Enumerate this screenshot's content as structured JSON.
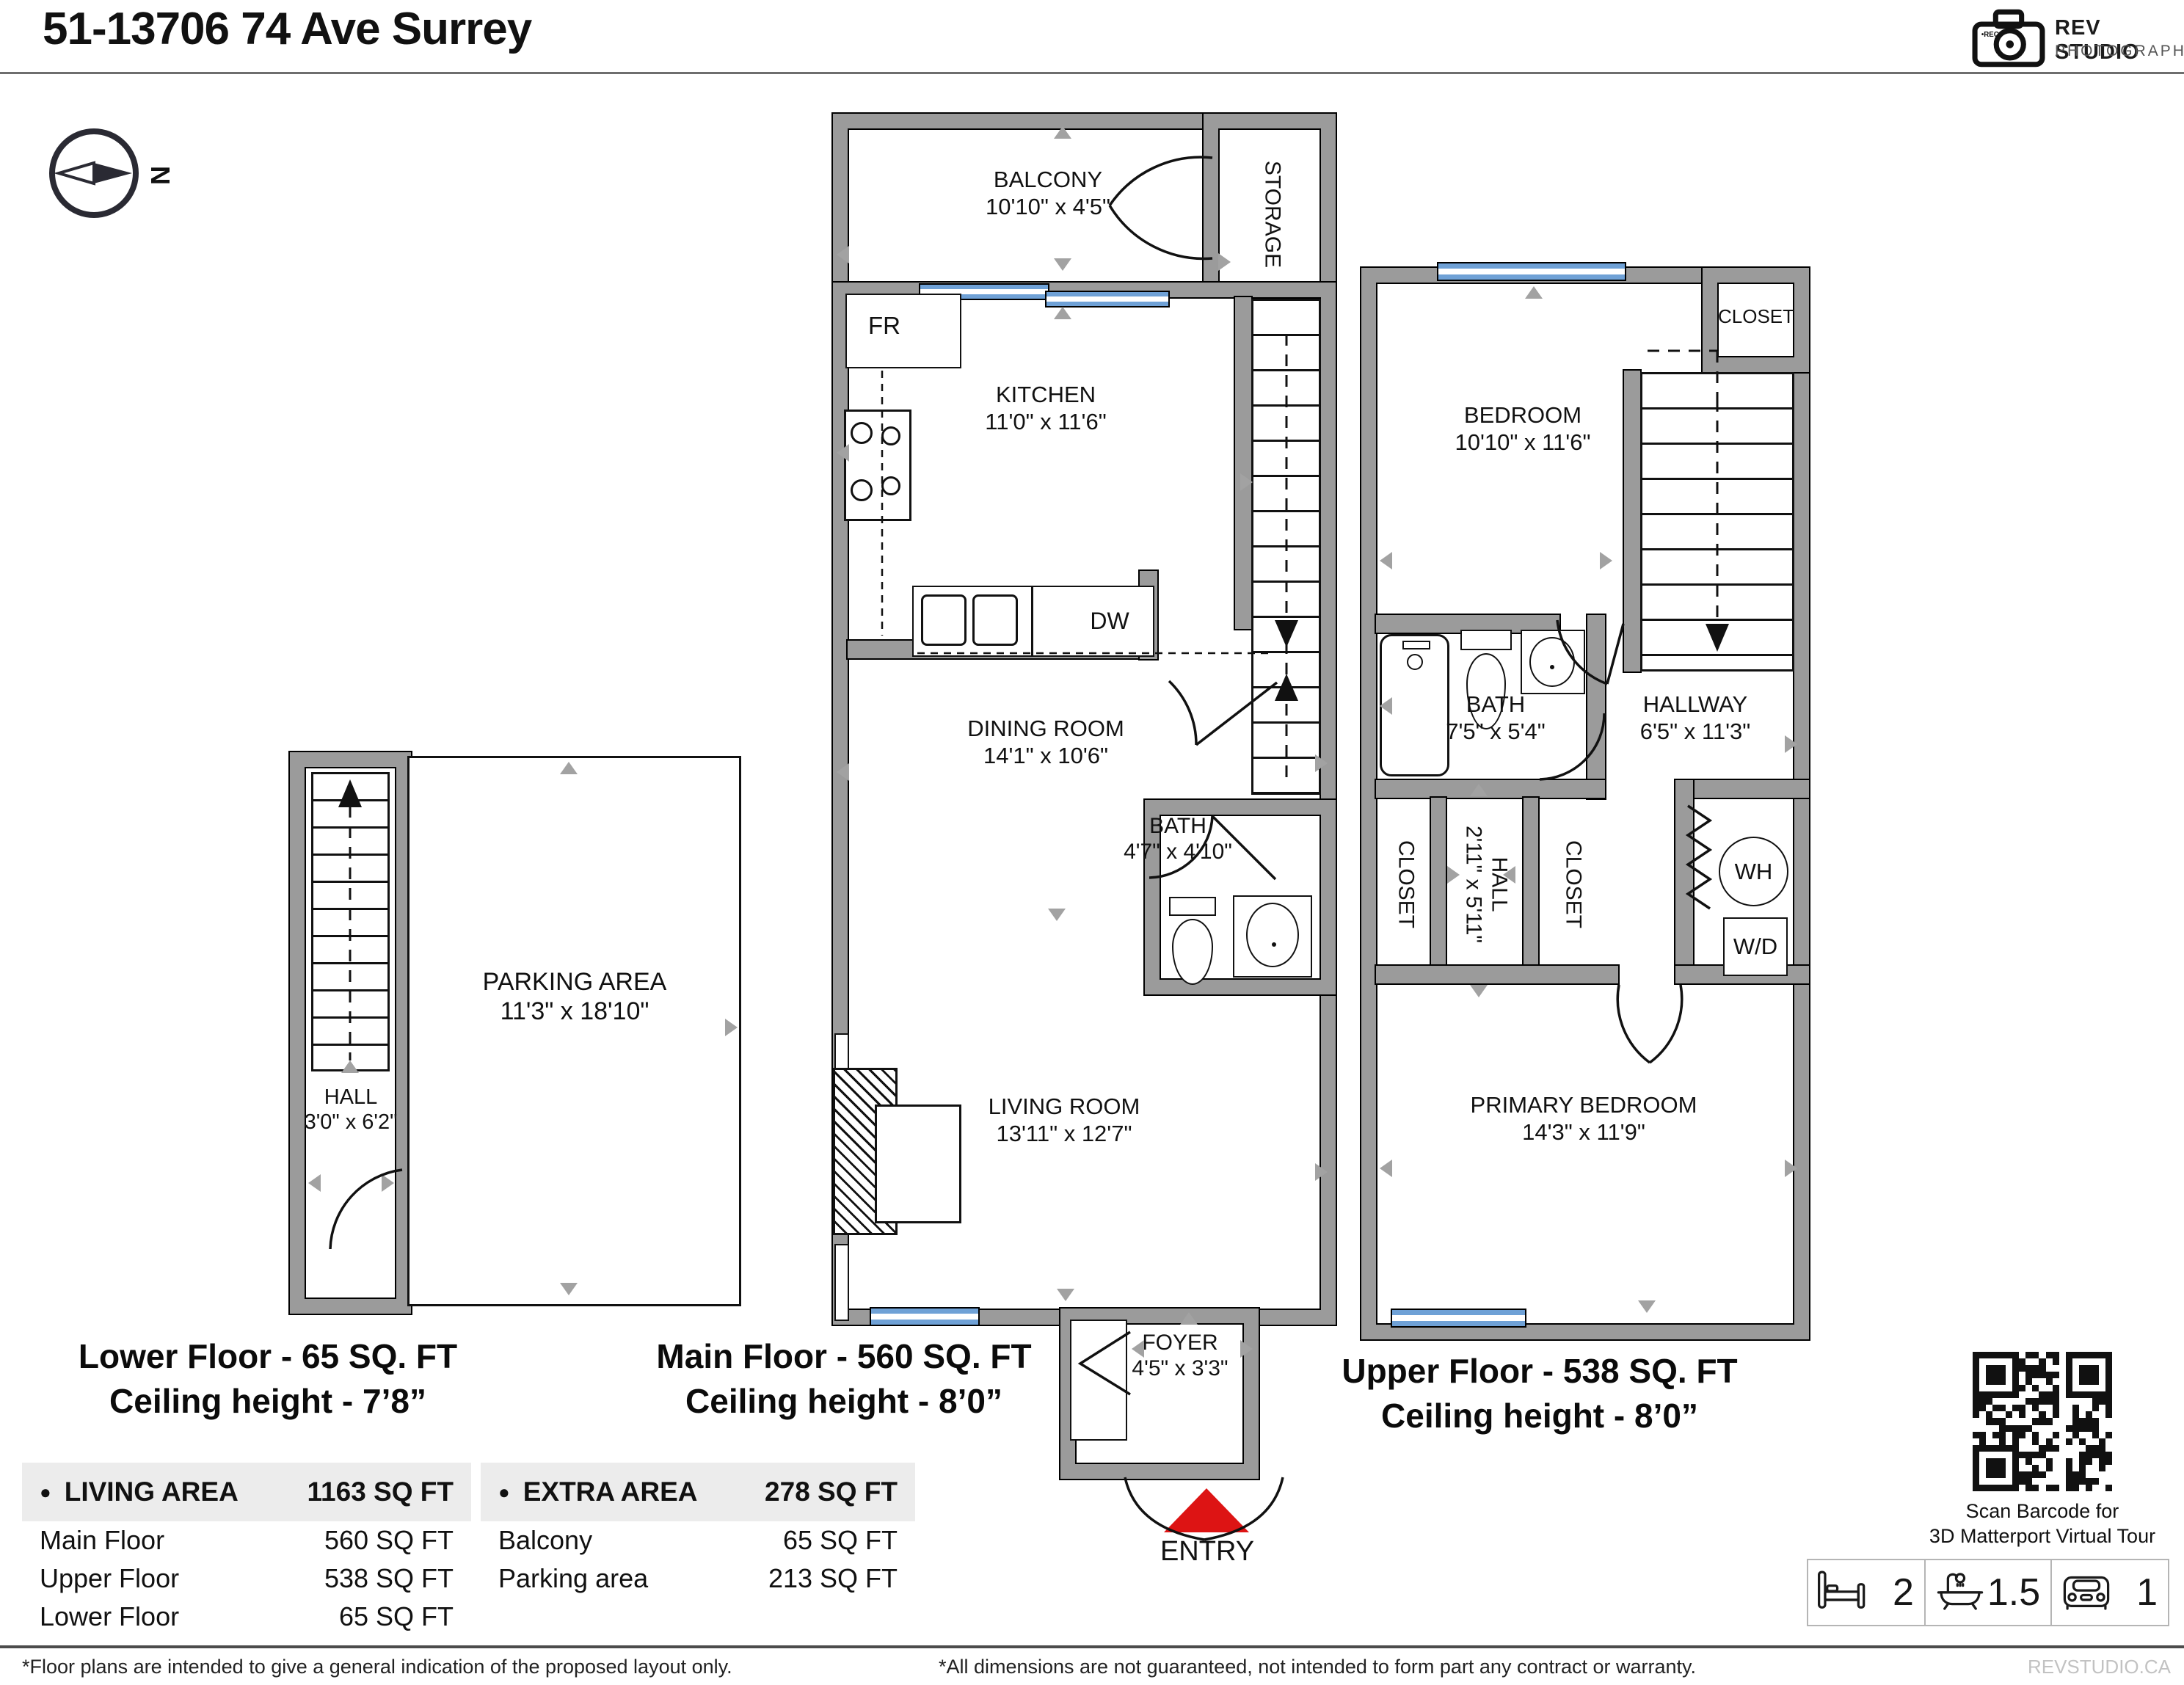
{
  "header": {
    "title": "51-13706 74 Ave Surrey",
    "logo_line1": "REV STUDIO",
    "logo_line2": "PHOTOGRAPHY",
    "logo_rec": "REC",
    "compass_n": "N"
  },
  "plans": {
    "main": {
      "caption1": "Main Floor - 560 SQ. FT",
      "caption2": "Ceiling height - 8’0”",
      "balcony_name": "BALCONY",
      "balcony_dims": "10'10\" x 4'5\"",
      "storage": "STORAGE",
      "fr": "FR",
      "dw": "DW",
      "kitchen_name": "KITCHEN",
      "kitchen_dims": "11'0\" x 11'6\"",
      "dining_name": "DINING ROOM",
      "dining_dims": "14'1\" x 10'6\"",
      "bath_name": "BATH",
      "bath_dims": "4'7\" x 4'10\"",
      "living_name": "LIVING ROOM",
      "living_dims": "13'11\" x 12'7\"",
      "foyer_name": "FOYER",
      "foyer_dims": "4'5\" x 3'3\"",
      "entry": "ENTRY"
    },
    "upper": {
      "caption1": "Upper Floor - 538 SQ. FT",
      "caption2": "Ceiling height - 8’0”",
      "closet_top": "CLOSET",
      "bedroom_name": "BEDROOM",
      "bedroom_dims": "10'10\" x 11'6\"",
      "bath_name": "BATH",
      "bath_dims": "7'5\" x 5'4\"",
      "hallway_name": "HALLWAY",
      "hallway_dims": "6'5\" x 11'3\"",
      "closet_left": "CLOSET",
      "closet_right": "CLOSET",
      "hall_name": "HALL",
      "hall_dims": "2'11\" x 5'11\"",
      "wh": "WH",
      "wd": "W/D",
      "primary_name": "PRIMARY BEDROOM",
      "primary_dims": "14'3\" x 11'9\""
    },
    "lower": {
      "caption1": "Lower Floor - 65 SQ. FT",
      "caption2": "Ceiling height - 7’8”",
      "parking_name": "PARKING AREA",
      "parking_dims": "11'3\" x 18'10\"",
      "hall_name": "HALL",
      "hall_dims": "3'0\" x 6'2\""
    }
  },
  "tables": {
    "living_area": {
      "bullet": "●",
      "title": "LIVING AREA",
      "total": "1163 SQ FT",
      "rows": [
        {
          "label": "Main Floor",
          "value": "560 SQ FT"
        },
        {
          "label": "Upper Floor",
          "value": "538 SQ FT"
        },
        {
          "label": "Lower Floor",
          "value": "65 SQ FT"
        }
      ]
    },
    "extra_area": {
      "bullet": "●",
      "title": "EXTRA AREA",
      "total": "278 SQ FT",
      "rows": [
        {
          "label": "Balcony",
          "value": "65 SQ FT"
        },
        {
          "label": "Parking area",
          "value": "213 SQ FT"
        }
      ]
    }
  },
  "qr": {
    "caption1": "Scan Barcode for",
    "caption2": "3D Matterport Virtual Tour"
  },
  "stats": {
    "beds": "2",
    "baths": "1.5",
    "parking": "1"
  },
  "footer": {
    "left": "*Floor plans are intended to give a general indication of the proposed layout only.",
    "center": "*All dimensions are not guaranteed, not intended to form part any contract or warranty.",
    "right": "REVSTUDIO.CA"
  },
  "colors": {
    "wall": "#9b9b9b",
    "window": "#6fa1d6",
    "entry_marker": "#dd1414",
    "table_header_bg": "#ececec"
  }
}
